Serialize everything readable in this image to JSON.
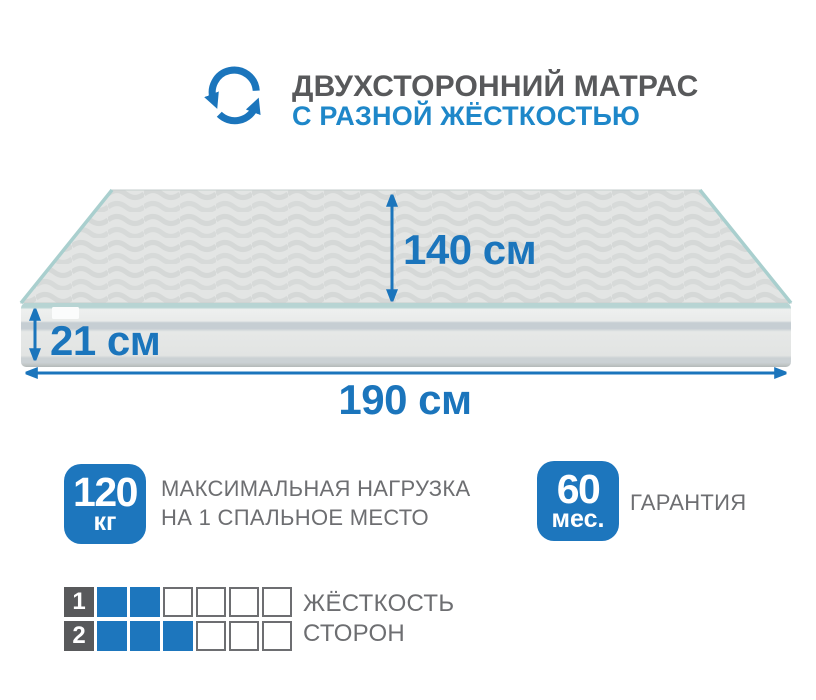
{
  "colors": {
    "accent_blue": "#1b75bc",
    "badge_blue": "#1d76bd",
    "subtitle_blue": "#1e87c9",
    "title_gray": "#58595b",
    "text_gray": "#6d6e71",
    "piping_teal": "#a9cfce"
  },
  "header": {
    "icon": "rotate-arrows-icon",
    "title": "ДВУХСТОРОННИЙ МАТРАС",
    "subtitle": "С РАЗНОЙ ЖЁСТКОСТЬЮ"
  },
  "mattress": {
    "width_label": "140 см",
    "height_label": "21 см",
    "length_label": "190 см"
  },
  "badges": [
    {
      "value": "120",
      "unit": "кг",
      "label_line1": "МАКСИМАЛЬНАЯ НАГРУЗКА",
      "label_line2": "НА 1 СПАЛЬНОЕ МЕСТО"
    },
    {
      "value": "60",
      "unit": "мес.",
      "label_line1": "ГАРАНТИЯ",
      "label_line2": ""
    }
  ],
  "firmness": {
    "label_line1": "ЖЁСТКОСТЬ",
    "label_line2": "СТОРОН",
    "scale_total": 6,
    "rows": [
      {
        "num": "1",
        "filled": 2
      },
      {
        "num": "2",
        "filled": 3
      }
    ]
  }
}
